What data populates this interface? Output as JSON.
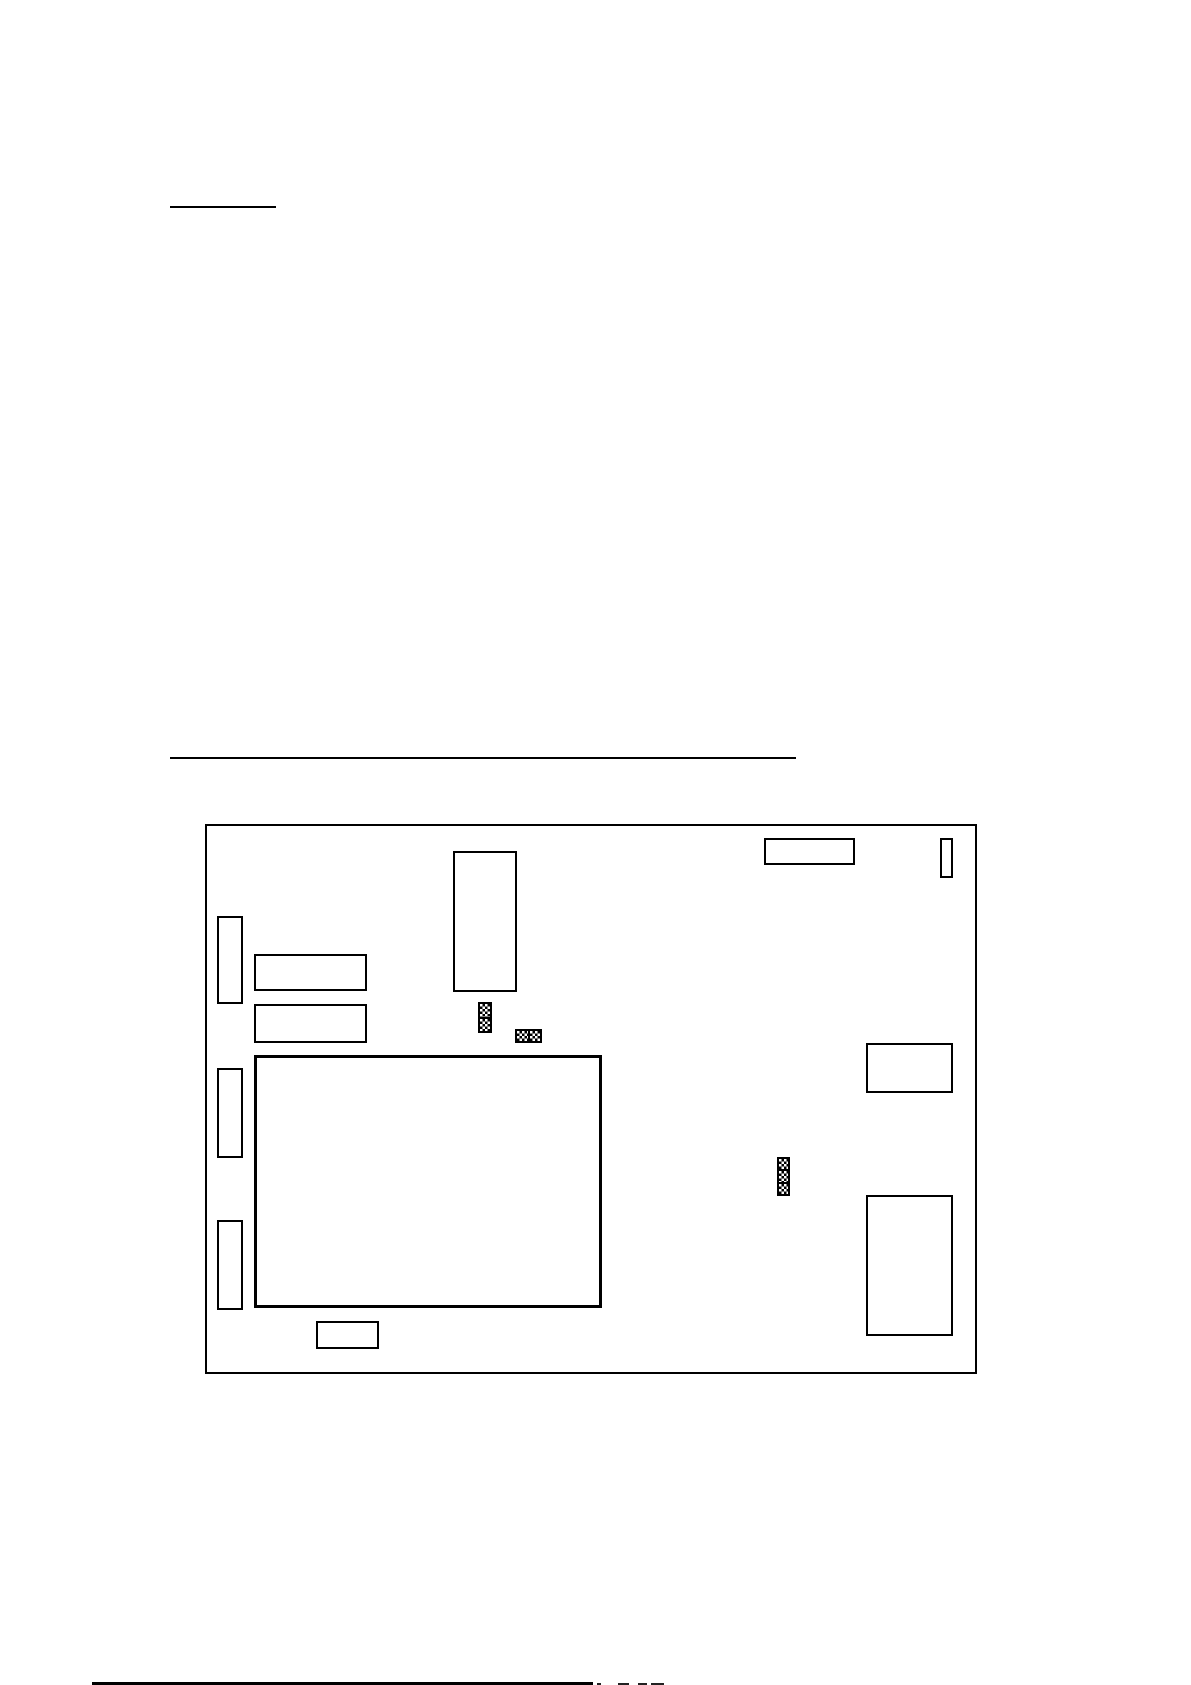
{
  "page": {
    "width": 1191,
    "height": 1685,
    "paper_color": "#ffffff",
    "ink_color": "#000000"
  },
  "rules": [
    {
      "id": "heading-underline-top",
      "x": 170,
      "y": 206,
      "w": 106,
      "h": 2
    },
    {
      "id": "section-underline",
      "x": 170,
      "y": 757,
      "w": 626,
      "h": 2
    },
    {
      "id": "footer-rule-cutoff",
      "x": 92,
      "y": 1682,
      "w": 501,
      "h": 3
    }
  ],
  "figure": {
    "board": {
      "id": "board-outline",
      "x": 205,
      "y": 824,
      "w": 772,
      "h": 550
    },
    "components": [
      {
        "id": "ic-vertical-top-center",
        "x": 453,
        "y": 851,
        "w": 64,
        "h": 141,
        "thick": false
      },
      {
        "id": "connector-top-right",
        "x": 764,
        "y": 838,
        "w": 91,
        "h": 27,
        "thick": false
      },
      {
        "id": "connector-top-far-right",
        "x": 940,
        "y": 838,
        "w": 13,
        "h": 40,
        "thick": false
      },
      {
        "id": "connector-left-1",
        "x": 217,
        "y": 916,
        "w": 26,
        "h": 88,
        "thick": false
      },
      {
        "id": "module-left-1",
        "x": 254,
        "y": 954,
        "w": 113,
        "h": 37,
        "thick": false
      },
      {
        "id": "module-left-2",
        "x": 254,
        "y": 1004,
        "w": 113,
        "h": 39,
        "thick": false
      },
      {
        "id": "connector-left-2",
        "x": 217,
        "y": 1068,
        "w": 26,
        "h": 90,
        "thick": false
      },
      {
        "id": "connector-left-3",
        "x": 217,
        "y": 1220,
        "w": 26,
        "h": 90,
        "thick": false
      },
      {
        "id": "ic-large-central",
        "x": 254,
        "y": 1055,
        "w": 348,
        "h": 253,
        "thick": true
      },
      {
        "id": "module-right-1",
        "x": 866,
        "y": 1043,
        "w": 87,
        "h": 50,
        "thick": false
      },
      {
        "id": "module-right-2",
        "x": 866,
        "y": 1195,
        "w": 87,
        "h": 141,
        "thick": false
      },
      {
        "id": "connector-bottom",
        "x": 316,
        "y": 1321,
        "w": 63,
        "h": 28,
        "thick": false
      }
    ],
    "jumpers": [
      {
        "id": "jumper-block-1",
        "x": 478,
        "y": 1002,
        "w": 14,
        "h": 31,
        "cells": 2,
        "orientation": "vertical"
      },
      {
        "id": "jumper-block-2",
        "x": 515,
        "y": 1029,
        "w": 27,
        "h": 14,
        "cells": 2,
        "orientation": "horizontal"
      },
      {
        "id": "jumper-block-3",
        "x": 777,
        "y": 1157,
        "w": 13,
        "h": 39,
        "cells": 3,
        "orientation": "vertical"
      }
    ]
  },
  "footer_marks": [
    {
      "id": "footer-text-fragment-1",
      "x": 597,
      "y": 1683,
      "w": 4,
      "h": 2
    },
    {
      "id": "footer-text-fragment-2",
      "x": 618,
      "y": 1683,
      "w": 11,
      "h": 2
    },
    {
      "id": "footer-text-fragment-3",
      "x": 638,
      "y": 1683,
      "w": 9,
      "h": 2
    },
    {
      "id": "footer-text-fragment-4",
      "x": 651,
      "y": 1683,
      "w": 13,
      "h": 2
    }
  ]
}
